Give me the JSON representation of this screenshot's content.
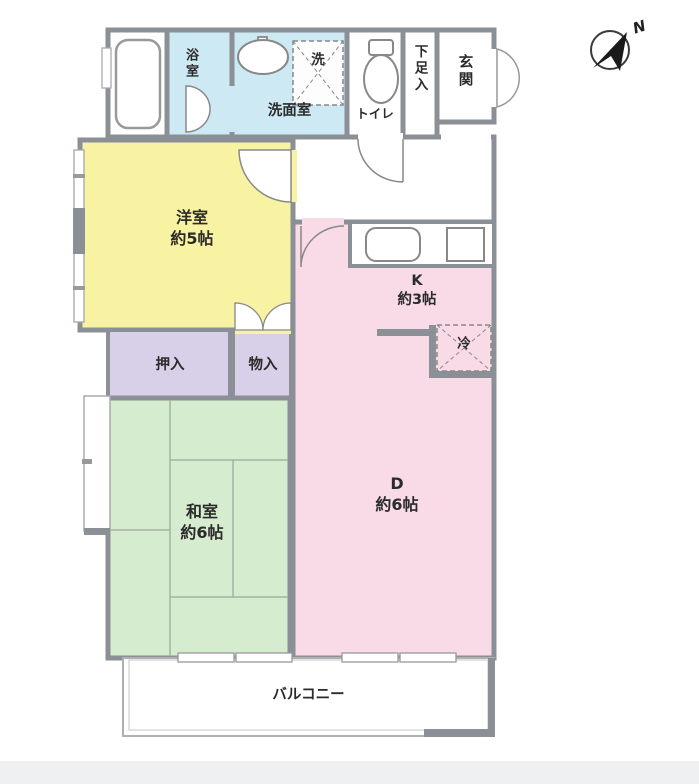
{
  "compass": {
    "label": "N"
  },
  "colors": {
    "wall": "#8b8f96",
    "bath_blue": "#cde9f4",
    "room_yellow": "#f8f3a2",
    "kd_pink": "#f9dbe8",
    "closet_purple": "#d8d0e8",
    "tatami_green": "#d6eccf",
    "white": "#ffffff",
    "thin_line": "#8c8c8c",
    "balcony_line": "#b0b0b0"
  },
  "rooms": {
    "bathroom": {
      "label": "浴室"
    },
    "washroom": {
      "label": "洗面室"
    },
    "washer": {
      "label": "洗"
    },
    "toilet": {
      "label": "トイレ"
    },
    "shoe_storage": {
      "label": "下足入"
    },
    "entrance": {
      "label": "玄関"
    },
    "western_room": {
      "label": "洋室",
      "size": "約5帖"
    },
    "kitchen": {
      "label": "K",
      "size": "約3帖"
    },
    "refrigerator": {
      "label": "冷"
    },
    "closet_oshiire": {
      "label": "押入"
    },
    "closet_monoire": {
      "label": "物入"
    },
    "japanese_room": {
      "label": "和室",
      "size": "約6帖"
    },
    "dining": {
      "label": "D",
      "size": "約6帖"
    },
    "balcony": {
      "label": "バルコニー"
    }
  }
}
